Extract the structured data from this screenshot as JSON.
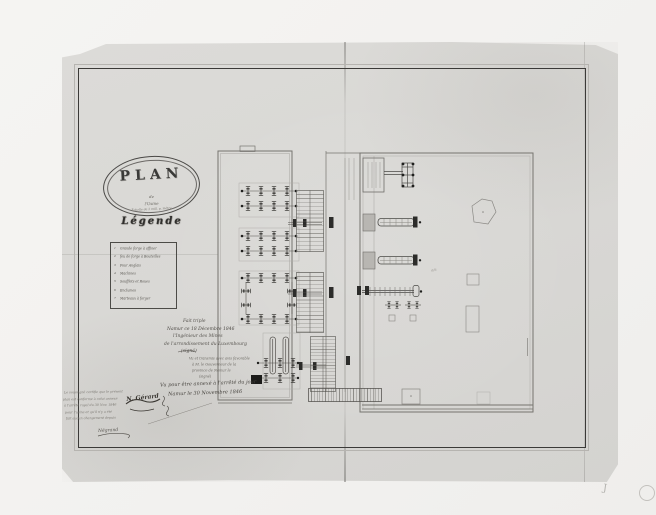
{
  "doc": {
    "title_cartouche": {
      "title": "PLAN",
      "line2": "de",
      "line3": "l'Usine",
      "line4": "Échelle de 2 mill. p. mètre"
    },
    "legend": {
      "heading": "Légende",
      "items": [
        {
          "num": "1",
          "label": "Grande forge à affiner"
        },
        {
          "num": "2",
          "label": "feu de forge à Bouteilles"
        },
        {
          "num": "3",
          "label": "Four Anglais"
        },
        {
          "num": "4",
          "label": "Machines"
        },
        {
          "num": "5",
          "label": "Soufflets et Roues"
        },
        {
          "num": "6",
          "label": "Enclumes"
        },
        {
          "num": "7",
          "label": "Marteaux à forger"
        }
      ]
    },
    "certification": {
      "block1": [
        "Fait triple",
        "Namur ce 18 Décembre 1846",
        "l'Ingénieur des Mines",
        "de l'arrondissement du Luxembourg",
        "(signé)"
      ],
      "block2": [
        "Vu et transmis avec avis favorable",
        "à M. le Gouverneur de la",
        "province de Namur le",
        "(signé)"
      ],
      "block3": [
        "Vu pour être annexé à l'arrêté du jour",
        "Namur le 30 Novembre 1846"
      ],
      "signature_main": "N. Gérard",
      "footnote": [
        "Le soussigné certifie que le présent",
        "plan est conforme à celui annexé",
        "à l'arrêté royal du 30 Nov. 1846",
        "pour l'usine et qu'il n'y a été",
        "fait aucun changement depuis"
      ],
      "signature_footnote": "Négrand"
    },
    "plan_annotation": "a/a",
    "margin": {
      "j_mark": "J"
    }
  },
  "colors": {
    "paper": "#d9d8d5",
    "photo_background": "#f2f1ef",
    "ink_frame": "#3b3a38",
    "drawing_line": "#5f5d59"
  }
}
